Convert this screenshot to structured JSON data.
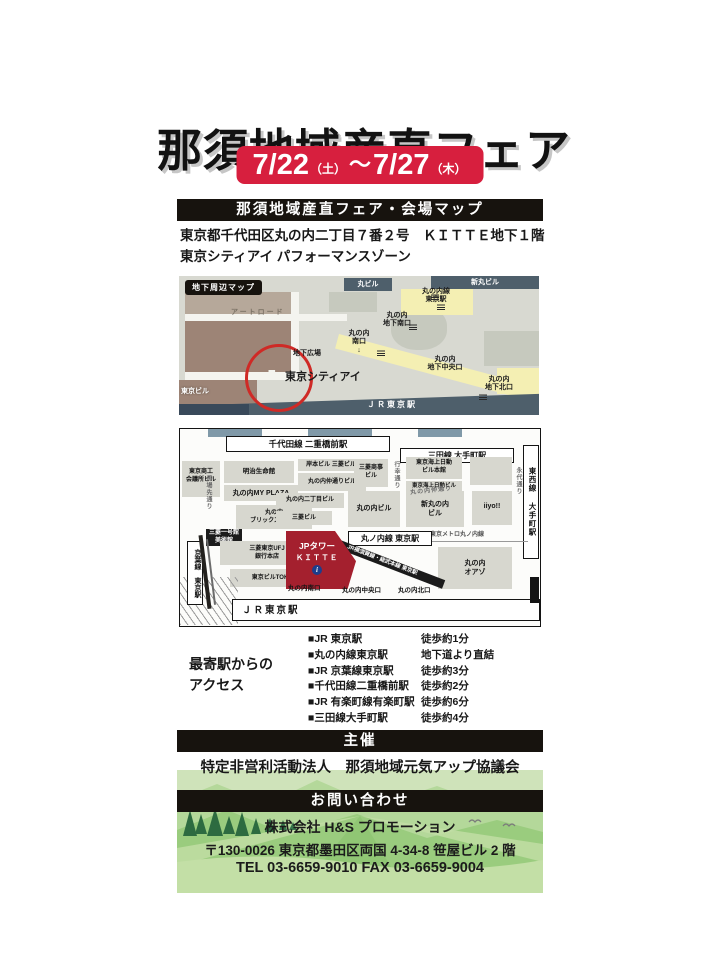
{
  "header": {
    "title": "那須地域産直フェア",
    "date_start": "7/22",
    "date_start_day": "（土）",
    "tilde": "～",
    "date_end": "7/27",
    "date_end_day": "（木）"
  },
  "venue": {
    "banner": "那須地域産直フェア・会場マップ",
    "address1": "東京都千代田区丸の内二丁目７番２号　ＫＩＴＴＥ地下１階",
    "address2": "東京シティアイ パフォーマンスゾーン"
  },
  "map1": {
    "badge": "地下周辺マップ",
    "art_road": "アートロード",
    "marubiru": "丸ビル",
    "shin_marubiru": "新丸ビル",
    "marunouchi_line_tokyo": "丸の内線\n東京駅",
    "chika_minami": "丸の内\n地下南口",
    "chika_hiroba": "地下広場",
    "minami_exit": "丸の内\n南口\n↓",
    "tokyo_city_i": "東京シティアイ",
    "chika_chuo": "丸の内\n地下中央口",
    "chika_kita": "丸の内\n地下北口",
    "jr_tokyo": "ＪＲ東京駅",
    "tokyo_bldg": "東京ビル"
  },
  "map2": {
    "chiyoda_station": "千代田線 二重橋前駅",
    "mita_station": "三田線 大手町駅",
    "tozai_station": "東西線 大手町駅",
    "keiyo_station": "京葉線 東京駅",
    "marunouchi_line_station": "丸ノ内線 東京駅",
    "metro_marunouchi_line": "東京メトロ丸ノ内線",
    "jr_yokosuka_line": "JR横須賀線・総武本線 東京駅",
    "jr_tokyo_station": "ＪＲ東京駅",
    "exit_minami": "丸の内南口",
    "exit_chuo": "丸の内中央口",
    "exit_kita": "丸の内北口",
    "jp_tower": "JPタワー",
    "kitte": "ＫＩＴＴＥ",
    "info_i": "i",
    "streets": {
      "babasaki": "馬場先通り",
      "gyoko": "行幸通り",
      "eitai": "永代通り",
      "nakadori": "丸の内仲通り"
    },
    "buildings": {
      "shoko": "東京商工\n会議所ビル",
      "meiji": "明治生命館",
      "myplaza": "丸の内MY PLAZA",
      "brick": "丸の内\nブリックスクエア",
      "ichigokan": "三菱一号館\n美術館",
      "ufj": "三菱東京UFJ\n銀行本店",
      "tokia": "東京ビルTOKIA",
      "kishimoto": "岸本ビル 三菱ビル",
      "nakadori_bldg": "丸の内仲通りビル",
      "shoji": "三菱商事\nビル",
      "nichome": "丸の内二丁目ビル",
      "mitsubishi": "三菱ビル",
      "marubiru": "丸の内ビル",
      "shinmaru": "新丸の内\nビル",
      "kaijo_honkan": "東京海上日動\nビル本館",
      "kaijo": "東京海上日動ビル",
      "iiyo": "iiyo!!",
      "oazo": "丸の内\nオアゾ"
    }
  },
  "access": {
    "heading": "最寄駅からの\nアクセス",
    "rows": [
      {
        "station": "■JR 東京駅",
        "time": "徒歩約1分"
      },
      {
        "station": "■丸の内線東京駅",
        "time": "地下道より直結"
      },
      {
        "station": "■JR 京葉線東京駅",
        "time": "徒歩約3分"
      },
      {
        "station": "■千代田線二重橋前駅",
        "time": "徒歩約2分"
      },
      {
        "station": "■JR 有楽町線有楽町駅",
        "time": "徒歩約6分"
      },
      {
        "station": "■三田線大手町駅",
        "time": "徒歩約4分"
      }
    ]
  },
  "organizer": {
    "banner": "主催",
    "name": "特定非営利活動法人　那須地域元気アップ協議会"
  },
  "contact": {
    "banner": "お問い合わせ",
    "company": "株式会社 H&S プロモーション",
    "address": "〒130-0026 東京都墨田区両国 4-34-8 笹屋ビル 2 階",
    "tel": "TEL 03-6659-9010 FAX 03-6659-9004"
  },
  "colors": {
    "date_red": "#d71f3e",
    "bar_black": "#17130e",
    "map_building_brown": "#9d8476",
    "map_rail_teal": "#4e5f6b",
    "map_path_yellow": "#f4efb3",
    "jp_tower_red": "#a4202e",
    "footer_green": "#cfe3ba"
  }
}
